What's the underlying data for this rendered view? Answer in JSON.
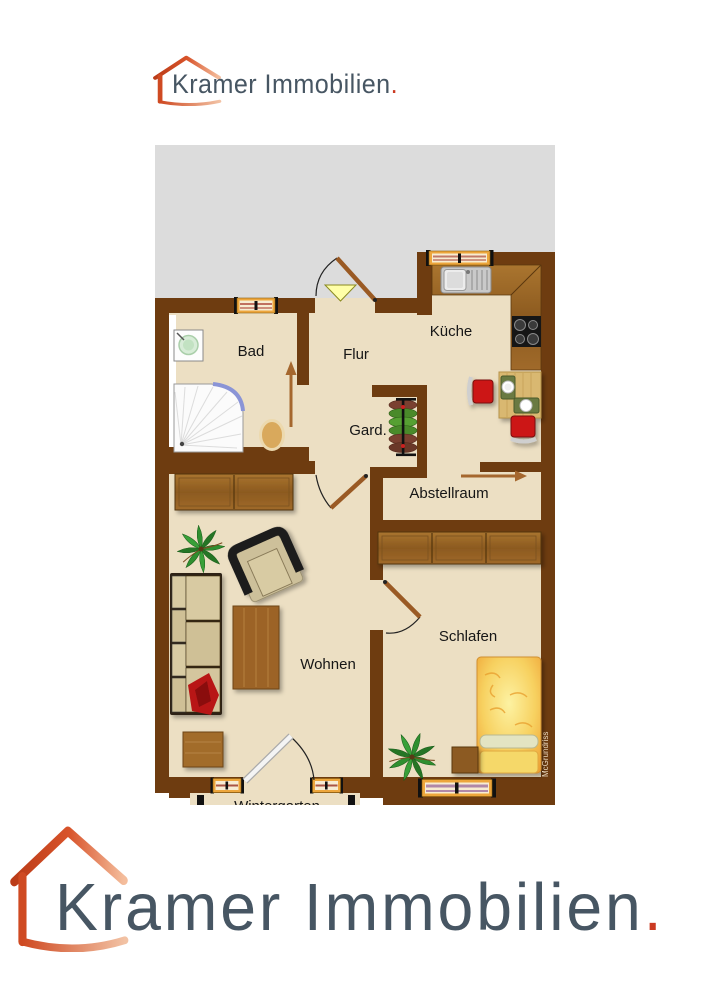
{
  "brand": {
    "name": "Kramer Immobilien",
    "dot": ".",
    "text_color": "#475663",
    "accent_color": "#cb3a22",
    "house_color": "#d04a22"
  },
  "plan": {
    "watermark": "McGrundriss",
    "wall_color": "#6e3c10",
    "floor_color": "#ecdfc3",
    "outside_color": "#dcdcdc",
    "rooms": [
      {
        "id": "bad",
        "label": "Bad"
      },
      {
        "id": "flur",
        "label": "Flur"
      },
      {
        "id": "kueche",
        "label": "Küche"
      },
      {
        "id": "garderobe",
        "label": "Gard."
      },
      {
        "id": "abstellraum",
        "label": "Abstellraum"
      },
      {
        "id": "wohnen",
        "label": "Wohnen"
      },
      {
        "id": "schlafen",
        "label": "Schlafen"
      },
      {
        "id": "wintergarten",
        "label": "Wintergarten"
      }
    ]
  }
}
